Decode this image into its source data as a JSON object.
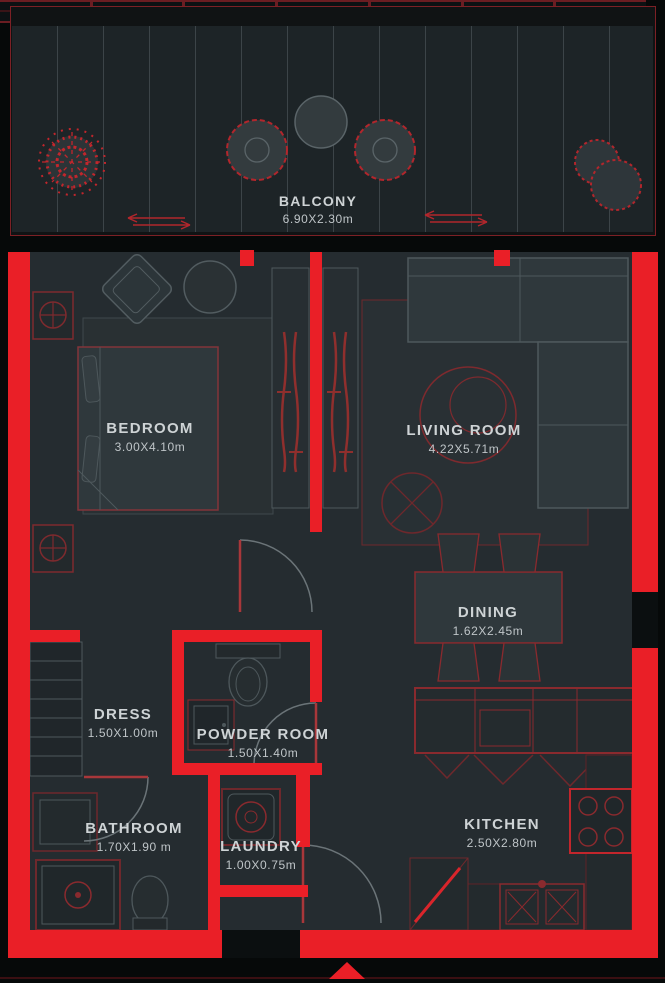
{
  "rooms": [
    {
      "id": "balcony",
      "name": "BALCONY",
      "dims": "6.90X2.30m"
    },
    {
      "id": "bedroom",
      "name": "BEDROOM",
      "dims": "3.00X4.10m"
    },
    {
      "id": "living_room",
      "name": "LIVING ROOM",
      "dims": "4.22X5.71m"
    },
    {
      "id": "dining",
      "name": "DINING",
      "dims": "1.62X2.45m"
    },
    {
      "id": "dress",
      "name": "DRESS",
      "dims": "1.50X1.00m"
    },
    {
      "id": "powder_room",
      "name": "POWDER ROOM",
      "dims": "1.50X1.40m"
    },
    {
      "id": "bathroom",
      "name": "BATHROOM",
      "dims": "1.70X1.90 m"
    },
    {
      "id": "laundry",
      "name": "LAUNDRY",
      "dims": "1.00X0.75m"
    },
    {
      "id": "kitchen",
      "name": "KITCHEN",
      "dims": "2.50X2.80m"
    }
  ],
  "icons": [
    "entrance-arrow-icon",
    "plant-icon",
    "shrub-icon",
    "door-arc",
    "bed",
    "sofa",
    "dining-table",
    "stove-icon",
    "sink-icon",
    "shower-icon",
    "toilet-icon",
    "washer-icon",
    "wardrobe"
  ],
  "colors": {
    "wall_red": "#ea1f27",
    "accent_red": "#c2262c",
    "dark_red": "#6e282c",
    "floor": "#252c30",
    "balcony_floor": "#1d2427",
    "background": "#060909",
    "furniture_gray": "#4e585c",
    "label_text": "#ced3d5",
    "dims_text": "#bfc5c8"
  }
}
